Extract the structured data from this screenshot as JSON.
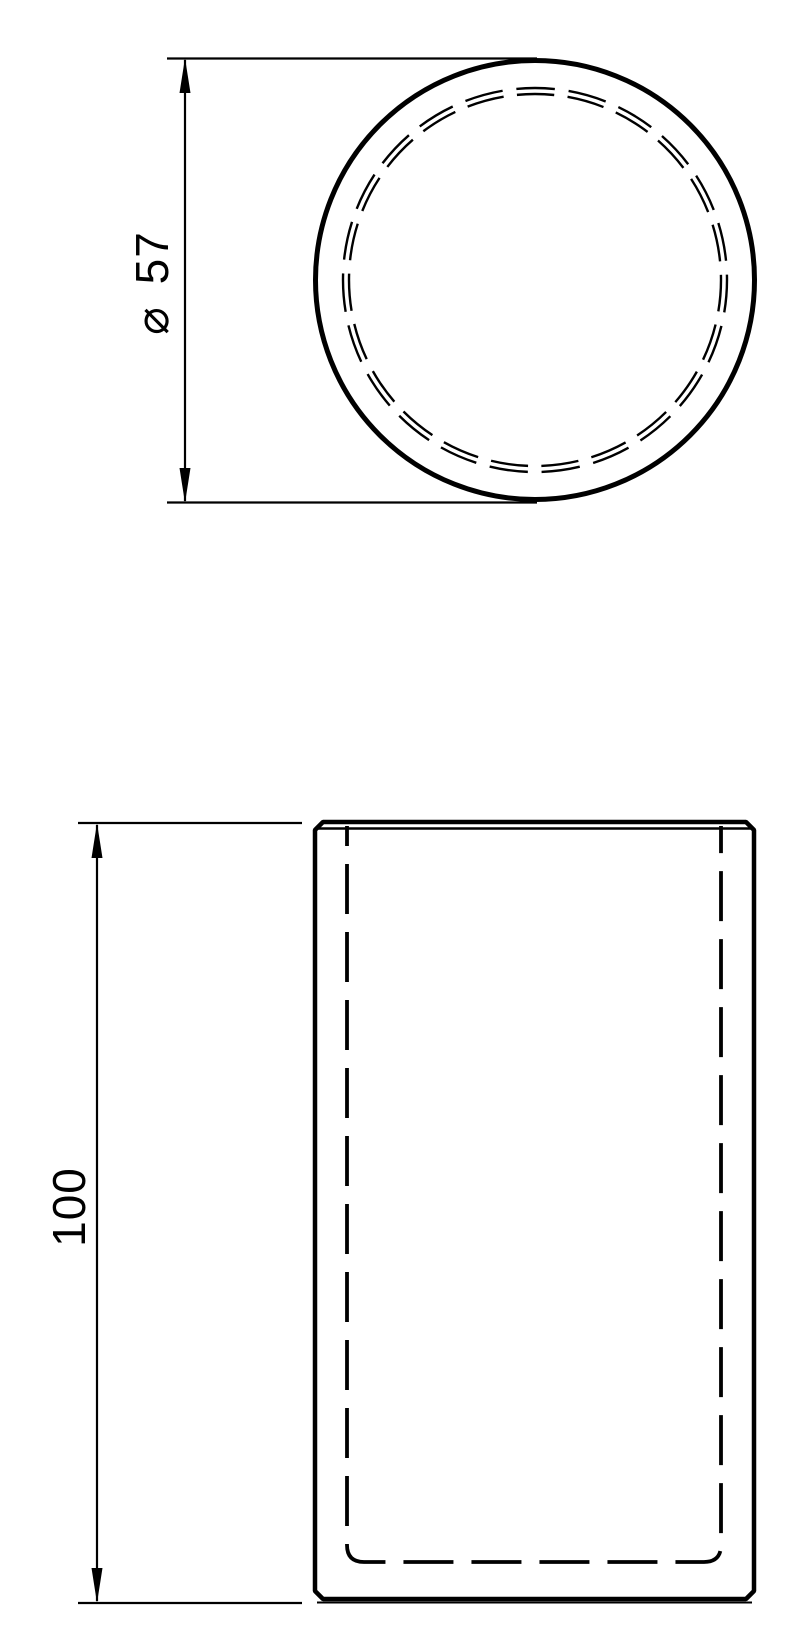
{
  "top_view": {
    "dimension_label": "⌀ 57",
    "dimension_symbol": "⌀",
    "dimension_value": "57"
  },
  "front_view": {
    "dimension_label": "100",
    "dimension_value": "100"
  },
  "style": {
    "line_color": "#000000",
    "background_color": "#ffffff"
  }
}
